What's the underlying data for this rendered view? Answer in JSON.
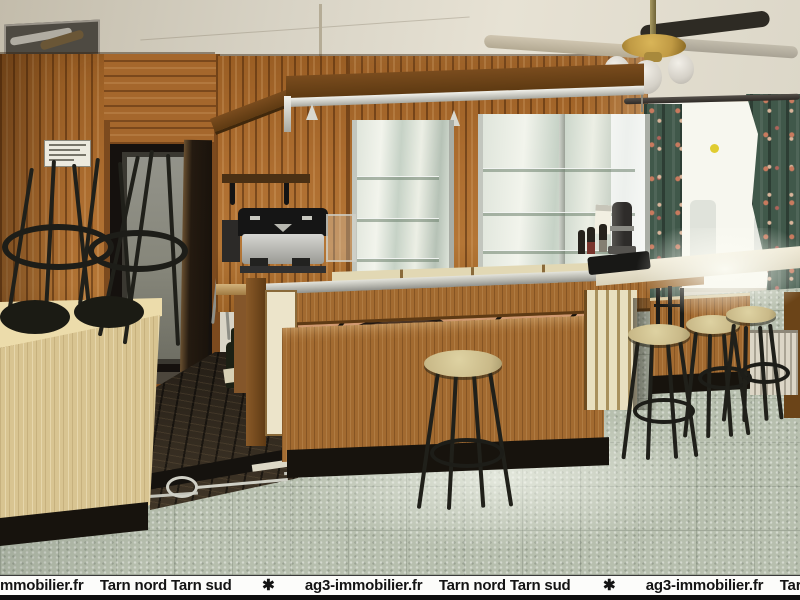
{
  "scene": {
    "type": "interior-photograph",
    "description": "Empty bar room of a cafe-restaurant: knotty pine panelled walls, wooden bar counter with chrome-edged top, mirrored back-bar display, bar stools, ceiling fan with brass light fittings, floral curtains at a bright window, speckled tile floor",
    "objects": [
      "ceiling-fan",
      "open-ceiling-tile",
      "pine-wall-panelling",
      "doorway",
      "wall-notice",
      "stacked-bar-stools",
      "espresso-machine",
      "wall-shelf",
      "back-bar-mirror-display",
      "bar-counter",
      "copper-recess",
      "bar-stools",
      "coffee-percolator",
      "bottles",
      "menu-card",
      "telephone",
      "window",
      "floral-curtains",
      "radiator",
      "tile-floor",
      "dark-wood-floor",
      "floor-cable",
      "bottle-on-floor"
    ]
  },
  "palette": {
    "ceiling": "#d9d4c6",
    "pine_wall": "#a86830",
    "pine_dark": "#8a4e1e",
    "bar_wood": "#a26a30",
    "light_counter_wood": "#d8c491",
    "stainless": "#c9c9c1",
    "copper_recess": "#c68a62",
    "mirror": "#dfe5db",
    "window_light": "#f7f7ef",
    "curtain_green": "#40584a",
    "curtain_flower": "#c87a5e",
    "tile_floor": "#b7bfae",
    "dark_wood_floor": "#2e261c",
    "plinth_black": "#17130d",
    "stool_seat": "#d4c795",
    "stool_leg": "#20201a",
    "radiator": "#dcd6c6",
    "brass": "#c09a44"
  },
  "watermark": {
    "background": "#fcfcfa",
    "text_color": "#141414",
    "bottom_bar_color": "#0d0d0d",
    "separator": "✱",
    "segments": [
      "mmobilier.fr",
      "Tarn nord Tarn sud",
      "✱",
      "ag3-immobilier.fr",
      "Tarn nord Tarn sud",
      "✱",
      "ag3-immobilier.fr",
      "Tarn nord Tarn"
    ]
  }
}
